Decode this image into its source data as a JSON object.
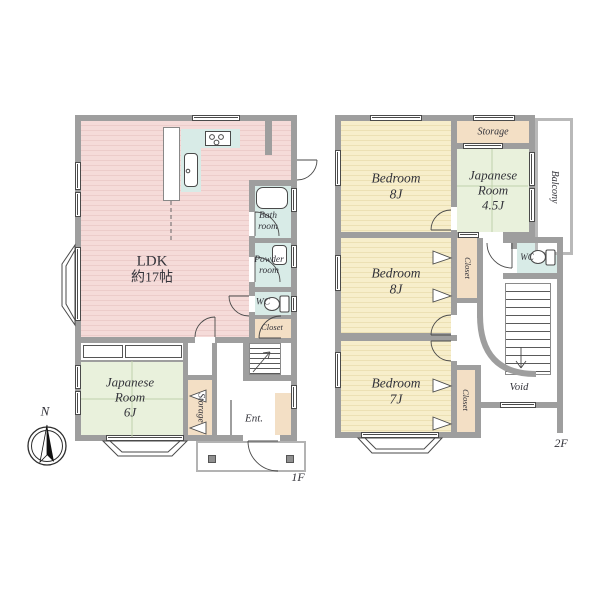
{
  "floor1": {
    "label": "1F",
    "ldk": {
      "name": "LDK",
      "area": "約17帖"
    },
    "japanese_room": {
      "l1": "Japanese",
      "l2": "Room",
      "l3": "6J"
    },
    "bath": {
      "l1": "Bath",
      "l2": "room"
    },
    "powder": {
      "l1": "Powder",
      "l2": "room"
    },
    "wc": "WC",
    "closet": "Closet",
    "storage": "Storage",
    "entrance": "Ent."
  },
  "floor2": {
    "label": "2F",
    "bedroom_top": {
      "l1": "Bedroom",
      "l2": "8J"
    },
    "bedroom_middle": {
      "l1": "Bedroom",
      "l2": "8J"
    },
    "bedroom_bottom": {
      "l1": "Bedroom",
      "l2": "7J"
    },
    "japanese_room": {
      "l1": "Japanese",
      "l2": "Room",
      "l3": "4.5J"
    },
    "storage": "Storage",
    "balcony": "Balcony",
    "closet_middle": "Closet",
    "closet_bottom": "Closet",
    "wc": "WC",
    "void": "Void"
  },
  "compass": {
    "north": "N"
  },
  "colors": {
    "wall": "#9e9e9e",
    "ldk_floor": "#f5dbd9",
    "bedroom_floor": "#f7eecb",
    "tatami_floor": "#e9f1dc",
    "wet_area": "#d8ebe7",
    "storage_fill": "#f3dfc5",
    "outline": "#4a4a4a"
  }
}
